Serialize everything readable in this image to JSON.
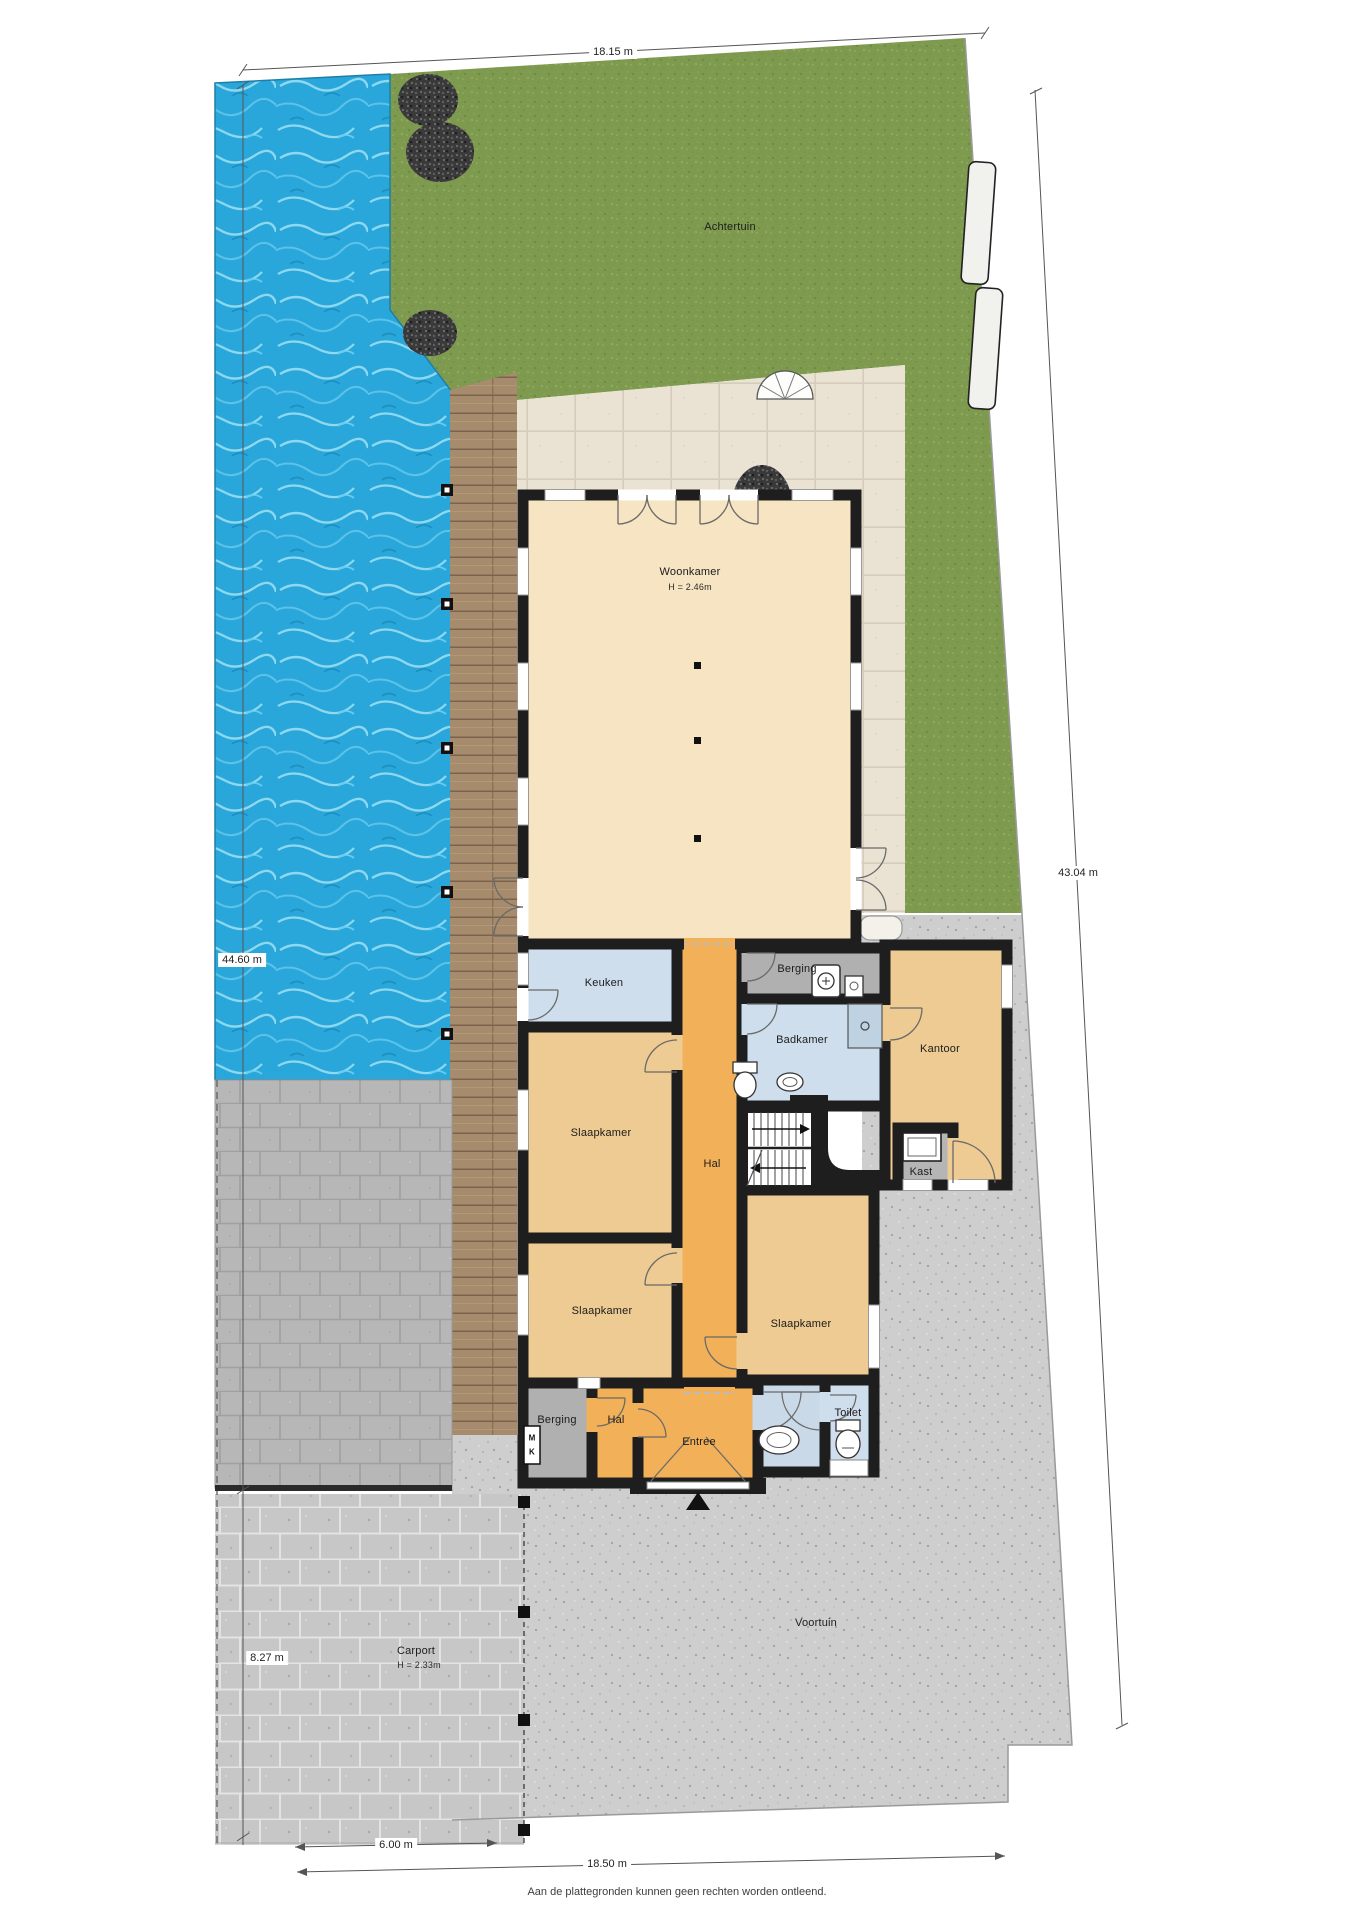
{
  "outdoor": {
    "back_garden_label": "Achtertuin",
    "front_garden_label": "Voortuin",
    "carport_label": "Carport",
    "carport_height": "H = 2.33m"
  },
  "rooms": {
    "living_room": {
      "label": "Woonkamer",
      "height": "H = 2.46m"
    },
    "kitchen": {
      "label": "Keuken"
    },
    "storage_middle": {
      "label": "Berging"
    },
    "bathroom": {
      "label": "Badkamer"
    },
    "office": {
      "label": "Kantoor"
    },
    "closet": {
      "label": "Kast"
    },
    "hall_main": {
      "label": "Hal"
    },
    "bedroom_1": {
      "label": "Slaapkamer"
    },
    "bedroom_2": {
      "label": "Slaapkamer"
    },
    "bedroom_3": {
      "label": "Slaapkamer"
    },
    "storage_front": {
      "label": "Berging"
    },
    "hall_front": {
      "label": "Hal"
    },
    "entrance": {
      "label": "Entree"
    },
    "toilet": {
      "label": "Toilet"
    },
    "meter_cupboard": {
      "line1": "M",
      "line2": "K"
    }
  },
  "dimensions": {
    "top_width": "18.15 m",
    "left_depth": "44.60 m",
    "right_depth": "43.04 m",
    "carport_depth": "8.27 m",
    "carport_width": "6.00 m",
    "bottom_width": "18.50 m"
  },
  "footer": "Aan de plattegronden kunnen geen rechten worden ontleend.",
  "colors": {
    "grass": "#7e9a4f",
    "water": "#2aa7da",
    "deck_wood": "#a68b6d",
    "terrace": "#eae3d4",
    "paving_speckle": "#cecece",
    "paving_blocks": "#c0c0c0",
    "room_cream": "#f6e4c3",
    "room_tan": "#edcb92",
    "room_orange": "#f2b159",
    "room_blue": "#cfdeed",
    "room_gray": "#b0b0b0",
    "wall": "#1e1e1e"
  }
}
